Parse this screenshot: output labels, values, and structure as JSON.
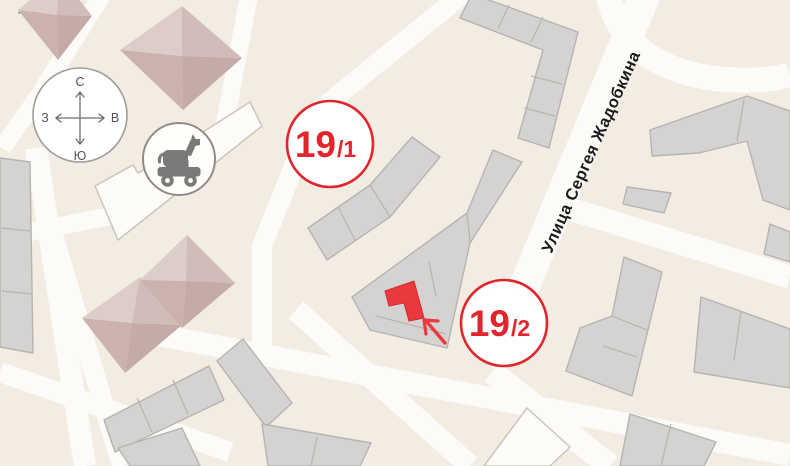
{
  "street": {
    "label": "Улица Сергея Жадобкина"
  },
  "markers": {
    "m1": {
      "number": "19",
      "suffix": "/1"
    },
    "m2": {
      "number": "19",
      "suffix": "/2"
    }
  },
  "compass": {
    "north": "С",
    "south": "Ю",
    "west": "З",
    "east": "В"
  },
  "icons": {
    "playground": "toy-horse-icon"
  },
  "colors": {
    "accent_red": "#e0262c",
    "highlight_building_red": "#e8393f",
    "building_gray": "#d4d3d1",
    "building_stroke": "#b6b4b1",
    "road_white": "#fcfbf8",
    "background_cream": "#f2ece2",
    "roof_pink_light": "#dccdc8",
    "roof_pink_dark": "#c5aba8"
  }
}
